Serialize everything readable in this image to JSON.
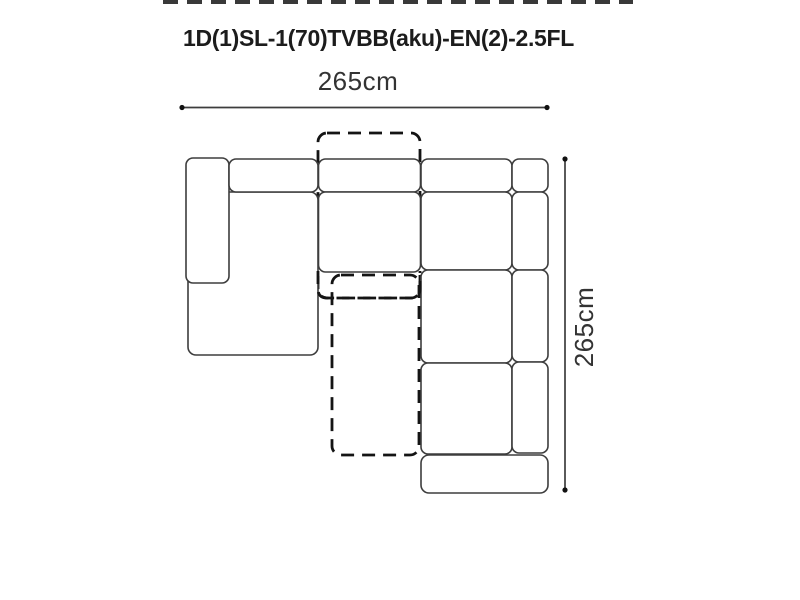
{
  "page": {
    "title": "1D(1)SL-1(70)TVBB(aku)-EN(2)-2.5FL"
  },
  "dimensions": {
    "width_label": "265cm",
    "height_label": "265cm"
  },
  "colors": {
    "line-color": "#3d3d3d",
    "dash-color": "#141414",
    "text-color": "#333333",
    "title-color": "#1c1c1c",
    "bg-color": "#ffffff"
  }
}
